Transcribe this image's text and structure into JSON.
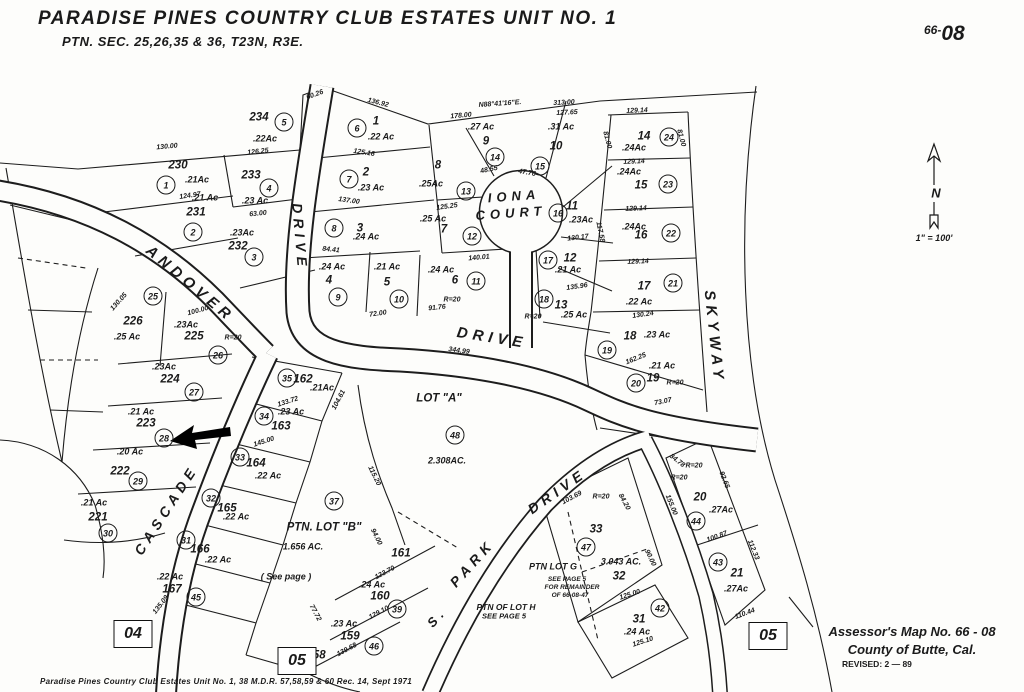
{
  "title": {
    "line1": "PARADISE  PINES  COUNTRY  CLUB  ESTATES  UNIT  NO. 1",
    "line2": "PTN. SEC. 25,26,35 & 36,   T23N,   R3E."
  },
  "sheet_number": {
    "small": "66-",
    "large": "08"
  },
  "compass": {
    "north_label": "N",
    "scale": "1\" = 100'"
  },
  "stamp": {
    "line1": "Assessor's   Map  No. 66 - 08",
    "line2": "County  of  Butte,  Cal.",
    "line3": "REVISED: 2 — 89"
  },
  "footer_note": "Paradise  Pines  Country  Club  Estates  Unit  No. 1,   38 M.D.R. 57,58,59 & 60  Rec. 14,   Sept 1971",
  "page_tabs": [
    {
      "label": "04",
      "x": 133,
      "y": 634
    },
    {
      "label": "05",
      "x": 297,
      "y": 661
    },
    {
      "label": "05",
      "x": 768,
      "y": 636
    }
  ],
  "streets": [
    {
      "name": "ANDOVER",
      "x": 190,
      "y": 284,
      "rot": 40,
      "size": 15
    },
    {
      "name": "DRIVE",
      "x": 300,
      "y": 237,
      "rot": 85,
      "size": 14
    },
    {
      "name": "DRIVE",
      "x": 492,
      "y": 338,
      "rot": 9,
      "size": 15
    },
    {
      "name": "IONA",
      "x": 514,
      "y": 196,
      "rot": -4,
      "size": 13
    },
    {
      "name": "COURT",
      "x": 511,
      "y": 213,
      "rot": -4,
      "size": 13
    },
    {
      "name": "SKYWAY",
      "x": 714,
      "y": 337,
      "rot": 84,
      "size": 15
    },
    {
      "name": "CASCADE",
      "x": 166,
      "y": 510,
      "rot": -57,
      "size": 14
    },
    {
      "name": "PARK",
      "x": 472,
      "y": 563,
      "rot": -48,
      "size": 14
    },
    {
      "name": "DRIVE",
      "x": 557,
      "y": 491,
      "rot": -35,
      "size": 14
    },
    {
      "name": "S.",
      "x": 437,
      "y": 617,
      "rot": -48,
      "size": 13
    }
  ],
  "lots": [
    {
      "num": "230",
      "circle": "1",
      "acre": ".21Ac",
      "nx": 178,
      "ny": 166,
      "cx": 166,
      "cy": 185,
      "ax": 197,
      "ay": 180
    },
    {
      "num": "231",
      "circle": "2",
      "acre": ".21 Ac",
      "nx": 196,
      "ny": 213,
      "cx": 193,
      "cy": 232,
      "ax": 205,
      "ay": 198
    },
    {
      "num": "232",
      "circle": "3",
      "acre": ".23Ac",
      "nx": 238,
      "ny": 247,
      "cx": 254,
      "cy": 257,
      "ax": 242,
      "ay": 233
    },
    {
      "num": "233",
      "circle": "4",
      "acre": ".23 Ac",
      "nx": 251,
      "ny": 176,
      "cx": 269,
      "cy": 188,
      "ax": 255,
      "ay": 201
    },
    {
      "num": "234",
      "circle": "5",
      "acre": ".22Ac",
      "nx": 259,
      "ny": 118,
      "cx": 284,
      "cy": 122,
      "ax": 265,
      "ay": 139
    },
    {
      "num": "1",
      "circle": "6",
      "acre": ".22 Ac",
      "nx": 376,
      "ny": 122,
      "cx": 357,
      "cy": 128,
      "ax": 381,
      "ay": 137
    },
    {
      "num": "2",
      "circle": "7",
      "acre": ".23 Ac",
      "nx": 366,
      "ny": 173,
      "cx": 349,
      "cy": 179,
      "ax": 371,
      "ay": 188
    },
    {
      "num": "3",
      "circle": "8",
      "acre": ".24 Ac",
      "nx": 360,
      "ny": 229,
      "cx": 334,
      "cy": 228,
      "ax": 366,
      "ay": 237
    },
    {
      "num": "4",
      "circle": "9",
      "acre": ".24 Ac",
      "nx": 329,
      "ny": 281,
      "cx": 338,
      "cy": 297,
      "ax": 332,
      "ay": 267
    },
    {
      "num": "5",
      "circle": "10",
      "acre": ".21 Ac",
      "nx": 387,
      "ny": 283,
      "cx": 399,
      "cy": 299,
      "ax": 387,
      "ay": 267
    },
    {
      "num": "6",
      "circle": "11",
      "acre": ".24 Ac",
      "nx": 455,
      "ny": 281,
      "cx": 476,
      "cy": 281,
      "ax": 441,
      "ay": 270
    },
    {
      "num": "7",
      "circle": "12",
      "acre": ".25 Ac",
      "nx": 444,
      "ny": 230,
      "cx": 472,
      "cy": 236,
      "ax": 433,
      "ay": 219
    },
    {
      "num": "8",
      "circle": "13",
      "acre": ".25Ac",
      "nx": 438,
      "ny": 166,
      "cx": 466,
      "cy": 191,
      "ax": 431,
      "ay": 184
    },
    {
      "num": "9",
      "circle": "14",
      "acre": ".27 Ac",
      "nx": 486,
      "ny": 142,
      "cx": 495,
      "cy": 157,
      "ax": 481,
      "ay": 127
    },
    {
      "num": "10",
      "circle": "15",
      "acre": ".31 Ac",
      "nx": 556,
      "ny": 147,
      "cx": 540,
      "cy": 166,
      "ax": 561,
      "ay": 127
    },
    {
      "num": "11",
      "circle": "16",
      "acre": ".23Ac",
      "nx": 572,
      "ny": 207,
      "cx": 558,
      "cy": 213,
      "ax": 581,
      "ay": 220
    },
    {
      "num": "12",
      "circle": "17",
      "acre": ".21 Ac",
      "nx": 570,
      "ny": 259,
      "cx": 548,
      "cy": 260,
      "ax": 568,
      "ay": 270
    },
    {
      "num": "13",
      "circle": "18",
      "acre": ".25 Ac",
      "nx": 561,
      "ny": 306,
      "cx": 544,
      "cy": 299,
      "ax": 574,
      "ay": 315
    },
    {
      "num": "14",
      "circle": "24",
      "acre": ".24Ac",
      "nx": 644,
      "ny": 137,
      "cx": 669,
      "cy": 137,
      "ax": 634,
      "ay": 148
    },
    {
      "num": "15",
      "circle": "23",
      "acre": ".24Ac",
      "nx": 641,
      "ny": 186,
      "cx": 668,
      "cy": 184,
      "ax": 629,
      "ay": 172
    },
    {
      "num": "16",
      "circle": "22",
      "acre": ".24Ac",
      "nx": 641,
      "ny": 236,
      "cx": 671,
      "cy": 233,
      "ax": 634,
      "ay": 227
    },
    {
      "num": "17",
      "circle": "21",
      "acre": ".22 Ac",
      "nx": 644,
      "ny": 287,
      "cx": 673,
      "cy": 283,
      "ax": 639,
      "ay": 302
    },
    {
      "num": "18",
      "circle": "19",
      "acre": ".23 Ac",
      "nx": 630,
      "ny": 337,
      "cx": 607,
      "cy": 350,
      "ax": 657,
      "ay": 335
    },
    {
      "num": "19",
      "circle": "20",
      "acre": ".21 Ac",
      "nx": 653,
      "ny": 379,
      "cx": 636,
      "cy": 383,
      "ax": 662,
      "ay": 366
    },
    {
      "num": "20",
      "circle": "44",
      "acre": ".27Ac",
      "nx": 700,
      "ny": 498,
      "cx": 696,
      "cy": 521,
      "ax": 721,
      "ay": 510
    },
    {
      "num": "21",
      "circle": "43",
      "acre": ".27Ac",
      "nx": 737,
      "ny": 574,
      "cx": 718,
      "cy": 562,
      "ax": 736,
      "ay": 589
    },
    {
      "num": "226",
      "circle": "25",
      "acre": ".25 Ac",
      "nx": 133,
      "ny": 322,
      "cx": 153,
      "cy": 296,
      "ax": 127,
      "ay": 337
    },
    {
      "num": "225",
      "circle": "26",
      "acre": ".23Ac",
      "nx": 194,
      "ny": 337,
      "cx": 218,
      "cy": 355,
      "ax": 186,
      "ay": 325
    },
    {
      "num": "224",
      "circle": "27",
      "acre": ".23Ac",
      "nx": 170,
      "ny": 380,
      "cx": 194,
      "cy": 392,
      "ax": 164,
      "ay": 367
    },
    {
      "num": "223",
      "circle": "28",
      "acre": ".21 Ac",
      "nx": 146,
      "ny": 424,
      "cx": 164,
      "cy": 438,
      "ax": 141,
      "ay": 412
    },
    {
      "num": "222",
      "circle": "29",
      "acre": ".20 Ac",
      "nx": 120,
      "ny": 472,
      "cx": 138,
      "cy": 481,
      "ax": 130,
      "ay": 452
    },
    {
      "num": "221",
      "circle": "30",
      "acre": ".21 Ac",
      "nx": 98,
      "ny": 518,
      "cx": 108,
      "cy": 533,
      "ax": 94,
      "ay": 503
    },
    {
      "num": "162",
      "circle": "35",
      "acre": ".21Ac",
      "nx": 303,
      "ny": 380,
      "cx": 287,
      "cy": 378,
      "ax": 322,
      "ay": 388
    },
    {
      "num": "163",
      "circle": "34",
      "acre": ".23 Ac",
      "nx": 281,
      "ny": 427,
      "cx": 264,
      "cy": 416,
      "ax": 291,
      "ay": 412
    },
    {
      "num": "164",
      "circle": "33",
      "acre": ".22 Ac",
      "nx": 256,
      "ny": 464,
      "cx": 240,
      "cy": 457,
      "ax": 268,
      "ay": 476
    },
    {
      "num": "165",
      "circle": "32",
      "acre": ".22 Ac",
      "nx": 227,
      "ny": 509,
      "cx": 211,
      "cy": 498,
      "ax": 236,
      "ay": 517
    },
    {
      "num": "166",
      "circle": "31",
      "acre": ".22 Ac",
      "nx": 200,
      "ny": 550,
      "cx": 186,
      "cy": 540,
      "ax": 218,
      "ay": 560
    },
    {
      "num": "167",
      "circle": "45",
      "acre": ".22 Ac",
      "nx": 172,
      "ny": 590,
      "cx": 196,
      "cy": 597,
      "ax": 170,
      "ay": 577
    },
    {
      "num": "161",
      "circle": null,
      "acre": null,
      "nx": 401,
      "ny": 554,
      "cx": 0,
      "cy": 0,
      "ax": 0,
      "ay": 0
    },
    {
      "num": "160",
      "circle": "39",
      "acre": ".24 Ac",
      "nx": 380,
      "ny": 597,
      "cx": 397,
      "cy": 609,
      "ax": 372,
      "ay": 585
    },
    {
      "num": "159",
      "circle": "46",
      "acre": ".23 Ac",
      "nx": 350,
      "ny": 637,
      "cx": 374,
      "cy": 646,
      "ax": 344,
      "ay": 624
    },
    {
      "num": "158",
      "circle": null,
      "acre": null,
      "nx": 316,
      "ny": 656,
      "cx": 0,
      "cy": 0,
      "ax": 0,
      "ay": 0
    },
    {
      "num": "33",
      "circle": "47",
      "acre": null,
      "nx": 596,
      "ny": 530,
      "cx": 586,
      "cy": 547,
      "ax": 0,
      "ay": 0
    },
    {
      "num": "32",
      "circle": null,
      "acre": "3.043 AC.",
      "nx": 619,
      "ny": 577,
      "cx": 0,
      "cy": 0,
      "ax": 621,
      "ay": 562
    },
    {
      "num": "31",
      "circle": "42",
      "acre": ".24 Ac",
      "nx": 639,
      "ny": 620,
      "cx": 660,
      "cy": 608,
      "ax": 637,
      "ay": 632
    }
  ],
  "areas": [
    {
      "name": "LOT  \"A\"",
      "circle": "48",
      "acre": "2.308AC.",
      "nx": 439,
      "ny": 399,
      "cx": 455,
      "cy": 435,
      "ax": 447,
      "ay": 461,
      "note": null,
      "tx": 0,
      "ty": 0
    },
    {
      "name": "PTN. LOT \"B\"",
      "circle": "37",
      "acre": "1.656  AC.",
      "nx": 324,
      "ny": 528,
      "cx": 334,
      "cy": 501,
      "ax": 303,
      "ay": 547,
      "note": "( See page   )",
      "tx": 286,
      "ty": 577
    }
  ],
  "notes": [
    {
      "text": "PTN LOT G",
      "x": 553,
      "y": 567,
      "size": 9
    },
    {
      "text": "SEE PAGE 5",
      "x": 567,
      "y": 580,
      "size": 6.5
    },
    {
      "text": "FOR REMAINDER",
      "x": 572,
      "y": 588,
      "size": 6.5
    },
    {
      "text": "OF 66-08-47",
      "x": 570,
      "y": 596,
      "size": 6.5
    },
    {
      "text": "PTN OF LOT H",
      "x": 506,
      "y": 607,
      "size": 8.5
    },
    {
      "text": "SEE PAGE 5",
      "x": 504,
      "y": 616,
      "size": 7.5
    }
  ],
  "measurements": [
    {
      "t": "N88°41'16\"E.",
      "x": 500,
      "y": 104,
      "r": -4
    },
    {
      "t": "178.00",
      "x": 461,
      "y": 116,
      "r": -5
    },
    {
      "t": "313.00",
      "x": 564,
      "y": 103,
      "r": -3
    },
    {
      "t": "127.65",
      "x": 567,
      "y": 113,
      "r": -3
    },
    {
      "t": "129.14",
      "x": 637,
      "y": 111,
      "r": -2
    },
    {
      "t": "129.14",
      "x": 634,
      "y": 162,
      "r": -2
    },
    {
      "t": "129.14",
      "x": 636,
      "y": 209,
      "r": -2
    },
    {
      "t": "129.14",
      "x": 638,
      "y": 262,
      "r": -2
    },
    {
      "t": "81.00",
      "x": 607,
      "y": 140,
      "r": 75
    },
    {
      "t": "81.00",
      "x": 681,
      "y": 138,
      "r": 75
    },
    {
      "t": "117.58",
      "x": 600,
      "y": 232,
      "r": 78
    },
    {
      "t": "130.24",
      "x": 643,
      "y": 315,
      "r": -8
    },
    {
      "t": "162.25",
      "x": 636,
      "y": 359,
      "r": -22
    },
    {
      "t": "73.07",
      "x": 663,
      "y": 402,
      "r": -12
    },
    {
      "t": "R=20",
      "x": 675,
      "y": 383,
      "r": 0
    },
    {
      "t": "34.78",
      "x": 677,
      "y": 461,
      "r": 38
    },
    {
      "t": "R=20",
      "x": 694,
      "y": 466,
      "r": 0
    },
    {
      "t": "R=20",
      "x": 679,
      "y": 478,
      "r": 0
    },
    {
      "t": "155.00",
      "x": 671,
      "y": 505,
      "r": 68
    },
    {
      "t": "92.65",
      "x": 724,
      "y": 480,
      "r": 68
    },
    {
      "t": "100.87",
      "x": 717,
      "y": 537,
      "r": -20
    },
    {
      "t": "112.33",
      "x": 753,
      "y": 550,
      "r": 68
    },
    {
      "t": "110.44",
      "x": 745,
      "y": 614,
      "r": -20
    },
    {
      "t": "125.00",
      "x": 630,
      "y": 595,
      "r": -18
    },
    {
      "t": "125.10",
      "x": 643,
      "y": 642,
      "r": -18
    },
    {
      "t": "130.00",
      "x": 167,
      "y": 147,
      "r": -5
    },
    {
      "t": "126.25",
      "x": 258,
      "y": 152,
      "r": -6
    },
    {
      "t": "124.97",
      "x": 190,
      "y": 196,
      "r": -8
    },
    {
      "t": "63.00",
      "x": 258,
      "y": 214,
      "r": -6
    },
    {
      "t": "60.26",
      "x": 315,
      "y": 95,
      "r": -20
    },
    {
      "t": "136.92",
      "x": 378,
      "y": 103,
      "r": 14
    },
    {
      "t": "125.16",
      "x": 364,
      "y": 153,
      "r": 9
    },
    {
      "t": "137.00",
      "x": 349,
      "y": 201,
      "r": 8
    },
    {
      "t": "84.41",
      "x": 331,
      "y": 250,
      "r": 6
    },
    {
      "t": "140.01",
      "x": 479,
      "y": 258,
      "r": -5
    },
    {
      "t": "125.25",
      "x": 447,
      "y": 207,
      "r": -8
    },
    {
      "t": "130.17",
      "x": 578,
      "y": 238,
      "r": -6
    },
    {
      "t": "135.96",
      "x": 577,
      "y": 287,
      "r": -8
    },
    {
      "t": "48.55",
      "x": 489,
      "y": 170,
      "r": -12
    },
    {
      "t": "47.76",
      "x": 527,
      "y": 173,
      "r": 10
    },
    {
      "t": "344.99",
      "x": 459,
      "y": 351,
      "r": 8
    },
    {
      "t": "91.76",
      "x": 437,
      "y": 308,
      "r": -6
    },
    {
      "t": "72.00",
      "x": 378,
      "y": 314,
      "r": -8
    },
    {
      "t": "R=20",
      "x": 452,
      "y": 300,
      "r": 0
    },
    {
      "t": "R=20",
      "x": 533,
      "y": 317,
      "r": 0
    },
    {
      "t": "R=20",
      "x": 233,
      "y": 338,
      "r": 0
    },
    {
      "t": "130.05",
      "x": 119,
      "y": 302,
      "r": -48
    },
    {
      "t": "100.00",
      "x": 198,
      "y": 311,
      "r": -15
    },
    {
      "t": "103.69",
      "x": 572,
      "y": 498,
      "r": -28
    },
    {
      "t": "R=20",
      "x": 601,
      "y": 497,
      "r": 0
    },
    {
      "t": "84.20",
      "x": 624,
      "y": 502,
      "r": 62
    },
    {
      "t": "90.00",
      "x": 650,
      "y": 558,
      "r": 65
    },
    {
      "t": "133.72",
      "x": 288,
      "y": 402,
      "r": -18
    },
    {
      "t": "145.00",
      "x": 264,
      "y": 442,
      "r": -18
    },
    {
      "t": "104.61",
      "x": 339,
      "y": 400,
      "r": -62
    },
    {
      "t": "115.20",
      "x": 374,
      "y": 476,
      "r": 64
    },
    {
      "t": "94.00",
      "x": 376,
      "y": 537,
      "r": 64
    },
    {
      "t": "123.70",
      "x": 385,
      "y": 573,
      "r": -28
    },
    {
      "t": "129.10",
      "x": 379,
      "y": 613,
      "r": -28
    },
    {
      "t": "139.68",
      "x": 347,
      "y": 650,
      "r": -28
    },
    {
      "t": "77.72",
      "x": 315,
      "y": 613,
      "r": 62
    },
    {
      "t": "135.09",
      "x": 161,
      "y": 605,
      "r": -52
    }
  ]
}
